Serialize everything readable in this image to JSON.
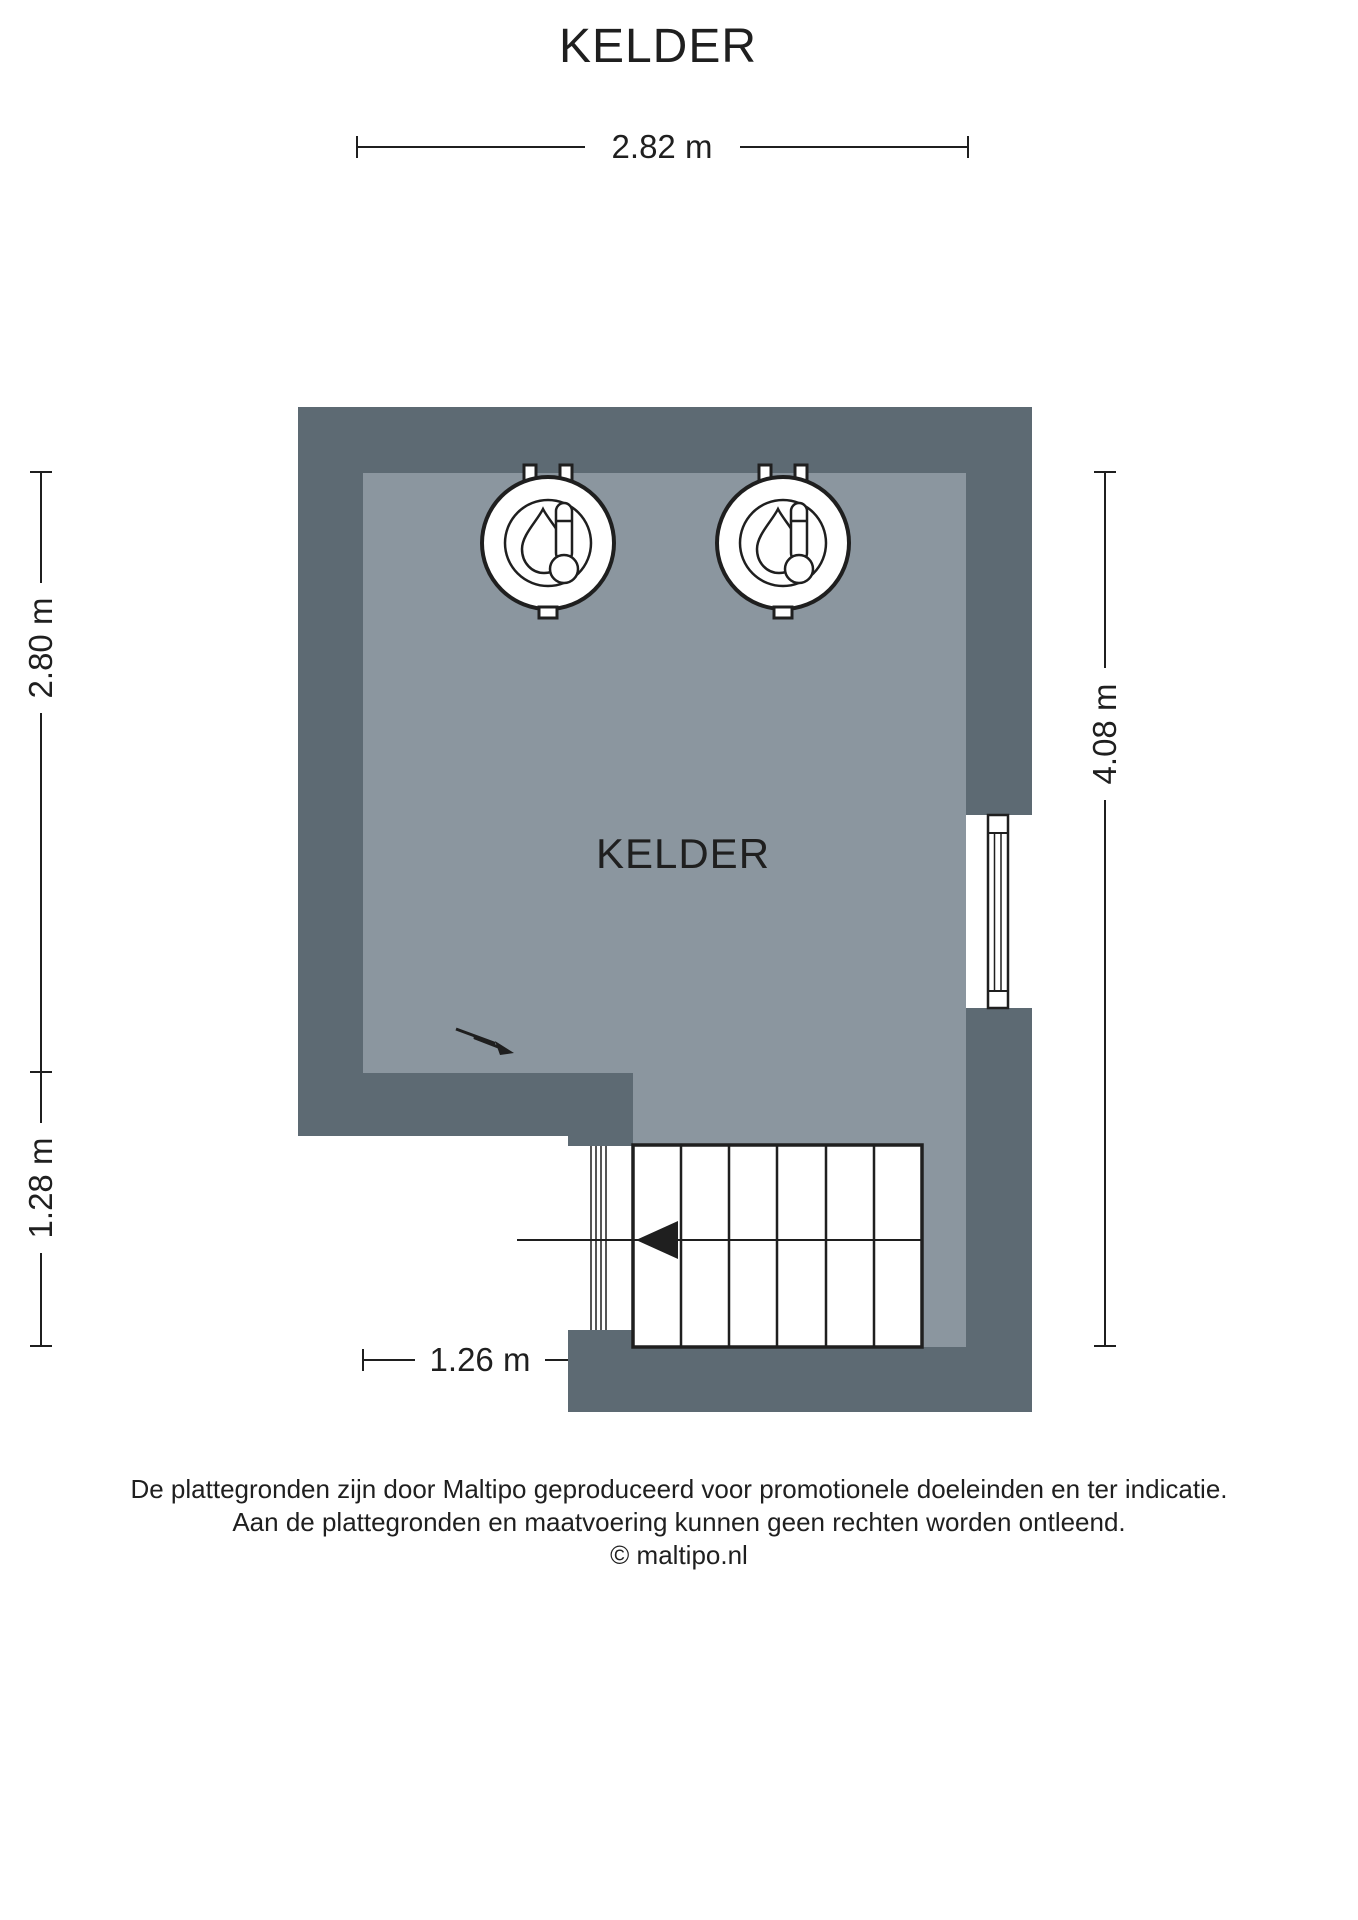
{
  "page": {
    "title": "KELDER"
  },
  "floorplan": {
    "room_label": "KELDER",
    "colors": {
      "wall": "#5d6a73",
      "floor": "#8b969f",
      "line": "#1f1f1f",
      "background": "#ffffff"
    },
    "dimensions": {
      "top": "2.82 m",
      "left_upper": "2.80 m",
      "left_lower": "1.28 m",
      "right": "4.08 m",
      "bottom_left": "1.26 m",
      "bottom_right": "1.56 m"
    },
    "symbols": [
      {
        "name": "boiler-icon",
        "count": 2
      },
      {
        "name": "window-symbol",
        "count": 1
      },
      {
        "name": "staircase-symbol",
        "treads": 6,
        "arrow_direction": "left"
      },
      {
        "name": "electrical-point-icon",
        "count": 1
      }
    ]
  },
  "footer": {
    "line1": "De plattegronden zijn door Maltipo geproduceerd voor promotionele doeleinden en ter indicatie.",
    "line2": "Aan de plattegronden en maatvoering kunnen geen rechten worden ontleend.",
    "line3": "© maltipo.nl"
  }
}
